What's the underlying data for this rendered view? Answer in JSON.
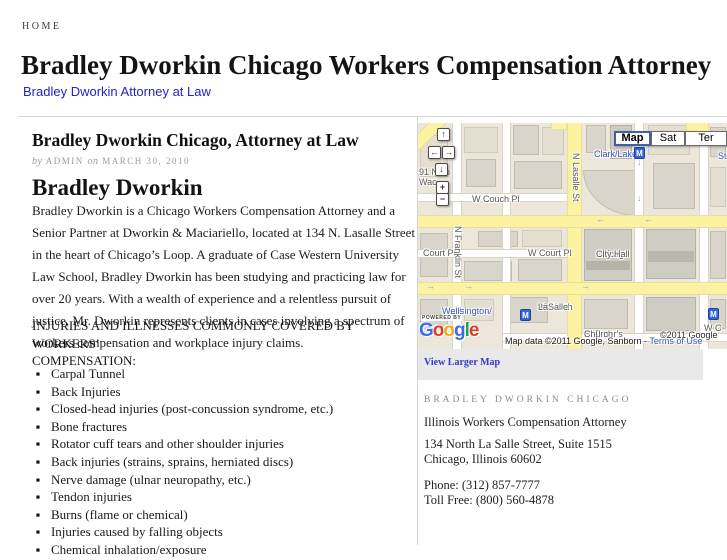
{
  "nav": {
    "home": "HOME"
  },
  "header": {
    "title": "Bradley Dworkin Chicago Workers Compensation Attorney",
    "subtitle_link": "Bradley Dworkin Attorney at Law"
  },
  "article": {
    "title": "Bradley Dworkin Chicago, Attorney at Law",
    "byline": {
      "by": "by",
      "author": "ADMIN",
      "on": "on",
      "date": "MARCH 30, 2010"
    },
    "heading": "Bradley Dworkin",
    "paragraph": "Bradley Dworkin is a Chicago Workers Compensation Attorney and a Senior Partner at Dworkin & Maciariello, located at 134 N. Lasalle Street in the heart of Chicago’s Loop. A graduate of Case Western University Law School, Bradley Dworkin has been studying and practicing law for over 20 years.  With a wealth of experience and a relentless pursuit of justice, Mr. Dworkin represents clients in cases involving a spectrum of workers compensation and workplace injury claims.",
    "list_heading_line1": "INJURIES AND ILLNESSES COMMONLY COVERED BY WORKERS’",
    "list_heading_line2": "COMPENSATION:",
    "injuries": [
      "Carpal Tunnel",
      "Back Injuries",
      "Closed-head injuries (post-concussion syndrome, etc.)",
      "Bone fractures",
      "Rotator cuff tears and other shoulder injuries",
      "Back injuries (strains, sprains, herniated discs)",
      "Nerve damage (ulnar neuropathy, etc.)",
      "Tendon injuries",
      "Burns (flame or chemical)",
      "Injuries caused by falling objects",
      "Chemical inhalation/exposure"
    ]
  },
  "map": {
    "view_larger": "View Larger Map",
    "type_buttons": {
      "map": "Map",
      "sat": "Sat",
      "ter": "Ter"
    },
    "controls": {
      "up": "↑",
      "left": "←",
      "right": "→",
      "down": "↓",
      "zoom_in": "+",
      "zoom_out": "−"
    },
    "metro": "M",
    "labels": {
      "clark_lake": "Clark/Lake",
      "state_cut": "St",
      "couch": "W Couch Pl",
      "lasalle": "N Lasalle St",
      "franklin": "N Franklin St",
      "court_pl": "Court Pl",
      "w_court_pl": "W Court Pl",
      "city_hall_1": "Chicago",
      "city_hall_2": "City Hall",
      "wash_1": "Washington/",
      "wash_2": "Wells",
      "north_lasalle_1": "30 North",
      "north_lasalle_2": "LaSalle",
      "st_peters_1": "St Peter's",
      "st_peters_2": "Church",
      "partial_91": "91 N",
      "partial_91b": "h",
      "partial_wac": "Wac",
      "w_c_cut": "W C",
      "copyright_right": "©2011 Google",
      "powered_by": "POWERED BY",
      "attrib_prefix": "Map data ©2011 Google, Sanborn - ",
      "terms": "Terms of Use"
    },
    "google_logo": [
      "G",
      "o",
      "o",
      "g",
      "l",
      "e"
    ],
    "arrow_glyphs": {
      "left": "←",
      "right": "→",
      "down": "↓"
    }
  },
  "sidebar": {
    "heading": "BRADLEY DWORKIN CHICAGO",
    "line1": "Illinois Workers Compensation Attorney",
    "address1": "134 North La Salle Street, Suite 1515",
    "address2": "Chicago, Illinois 60602",
    "phone": "Phone: (312) 857-7777",
    "tollfree": "Toll Free: (800) 560-4878"
  },
  "colors": {
    "link_blue": "#2323c8",
    "map_link_blue": "#3737d2",
    "road_yellow": "#fcf3a2",
    "metro_blue": "#3565d4",
    "divider_gray": "#d6d6d6"
  }
}
